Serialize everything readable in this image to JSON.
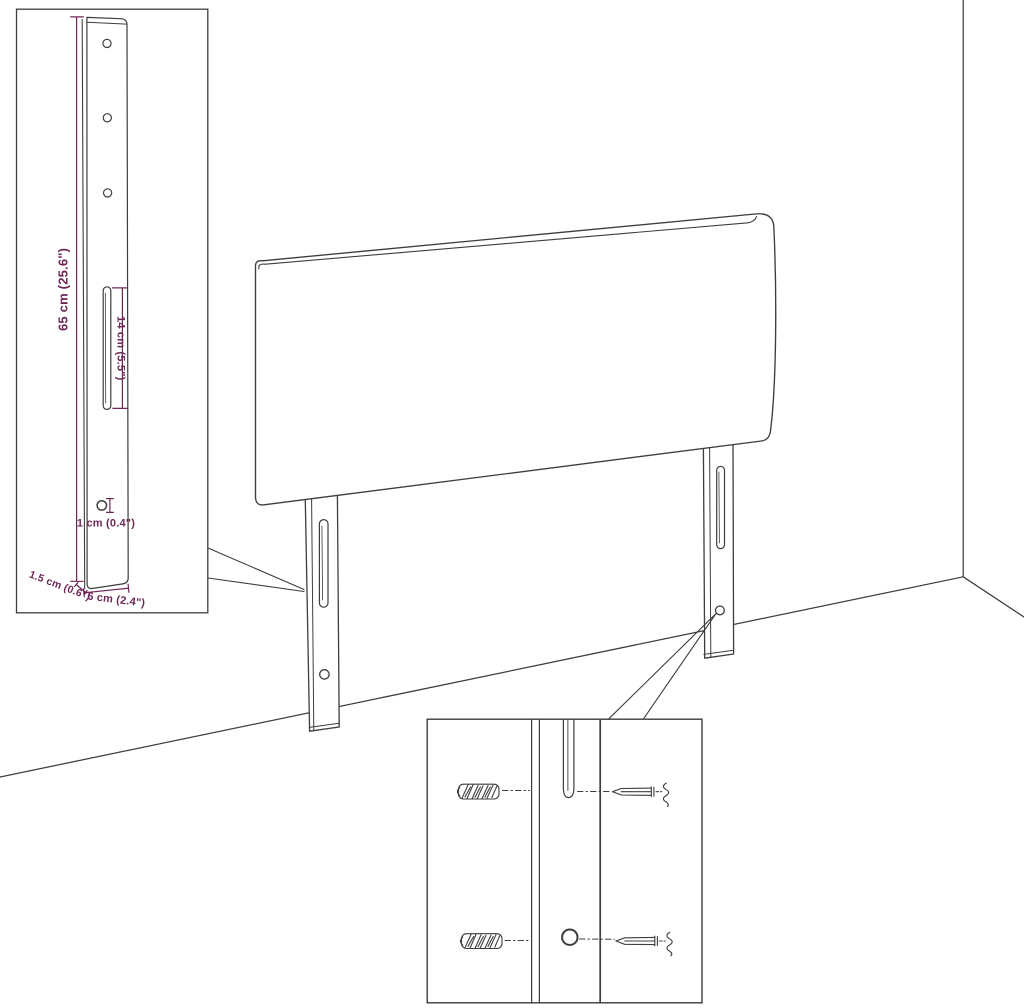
{
  "canvas": {
    "width": 1024,
    "height": 1008,
    "background": "#ffffff"
  },
  "colors": {
    "line": "#3d3d3d",
    "dimension": "#6e2858"
  },
  "dimension_labels": {
    "leg_height": "65 cm (25.6\")",
    "slot_length": "14 cm (5.5\")",
    "hole_diameter": "1 cm (0.4\")",
    "leg_thickness": "1.5 cm (0.6\")",
    "leg_width": "6 cm (2.4\")"
  }
}
